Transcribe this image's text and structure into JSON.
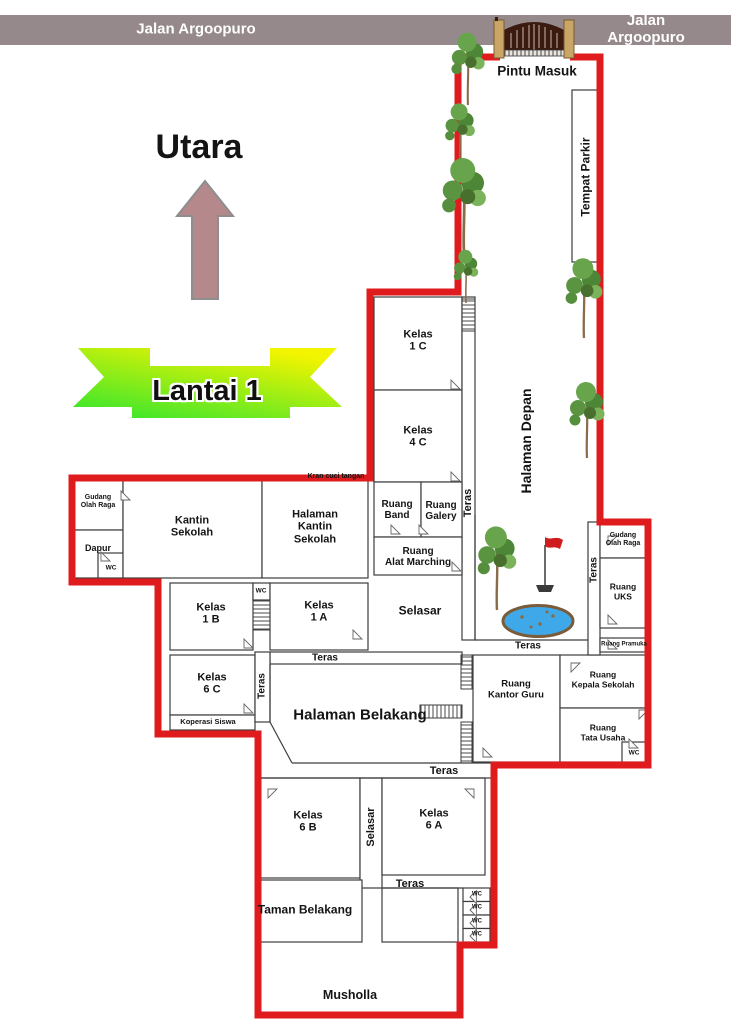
{
  "street_bar": {
    "left": "Jalan Argoopuro",
    "right": "Jalan Argoopuro"
  },
  "gate": {
    "label": "Pintu Masuk"
  },
  "compass": {
    "north_label": "Utara"
  },
  "floor_banner": {
    "label": "Lantai 1"
  },
  "rooms": {
    "tempat_parkir": "Tempat Parkir",
    "halaman_depan": "Halaman Depan",
    "kelas_1c": "Kelas\n1 C",
    "kelas_4c": "Kelas\n4 C",
    "teras_depan": "Teras",
    "ruang_band": "Ruang\nBand",
    "ruang_galery": "Ruang\nGalery",
    "ruang_alat_marching": "Ruang\nAlat Marching",
    "kran_cuci_tangan": "Kran cuci tangan",
    "gudang_olah_raga_barat": "Gudang\nOlah Raga",
    "dapur": "Dapur",
    "wc_dapur": "WC",
    "kantin_sekolah": "Kantin\nSekolah",
    "halaman_kantin_sekolah": "Halaman\nKantin\nSekolah",
    "kelas_1b": "Kelas\n1 B",
    "wc_tengah": "WC",
    "kelas_1a": "Kelas\n1 A",
    "selasar_tengah": "Selasar",
    "teras_kelas_1a": "Teras",
    "kelas_6c": "Kelas\n6 C",
    "koperasi_siswa": "Koperasi Siswa",
    "teras_kelas_6c": "Teras",
    "halaman_belakang": "Halaman Belakang",
    "teras_courtyard": "Teras",
    "teras_timur": "Teras",
    "gudang_olah_raga_timur": "Gudang\nOlah Raga",
    "ruang_uks": "Ruang\nUKS",
    "ruang_pramuka": "Ruang Pramuka",
    "ruang_kantor_guru": "Ruang\nKantor Guru",
    "ruang_kepala_sekolah": "Ruang\nKepala Sekolah",
    "ruang_tata_usaha": "Ruang\nTata Usaha",
    "wc_tata_usaha": "WC",
    "teras_halaman_belakang": "Teras",
    "kelas_6b": "Kelas\n6 B",
    "selasar_selatan": "Selasar",
    "kelas_6a": "Kelas\n6 A",
    "teras_kelas_6a": "Teras",
    "taman_belakang": "Taman Belakang",
    "wc_selatan_1": "WC",
    "wc_selatan_2": "WC",
    "wc_selatan_3": "WC",
    "wc_selatan_4": "WC",
    "musholla": "Musholla"
  },
  "colors": {
    "boundary_red": "#e01b1e",
    "street_bar_gray": "#95898b",
    "compass_arrow": "#b5888c",
    "banner_green": "#2fe52f",
    "banner_yellow": "#f2f400",
    "pond_blue": "#3fa8e8",
    "flag_red": "#cf1d1d",
    "gate_post_tan": "#c9a566"
  }
}
